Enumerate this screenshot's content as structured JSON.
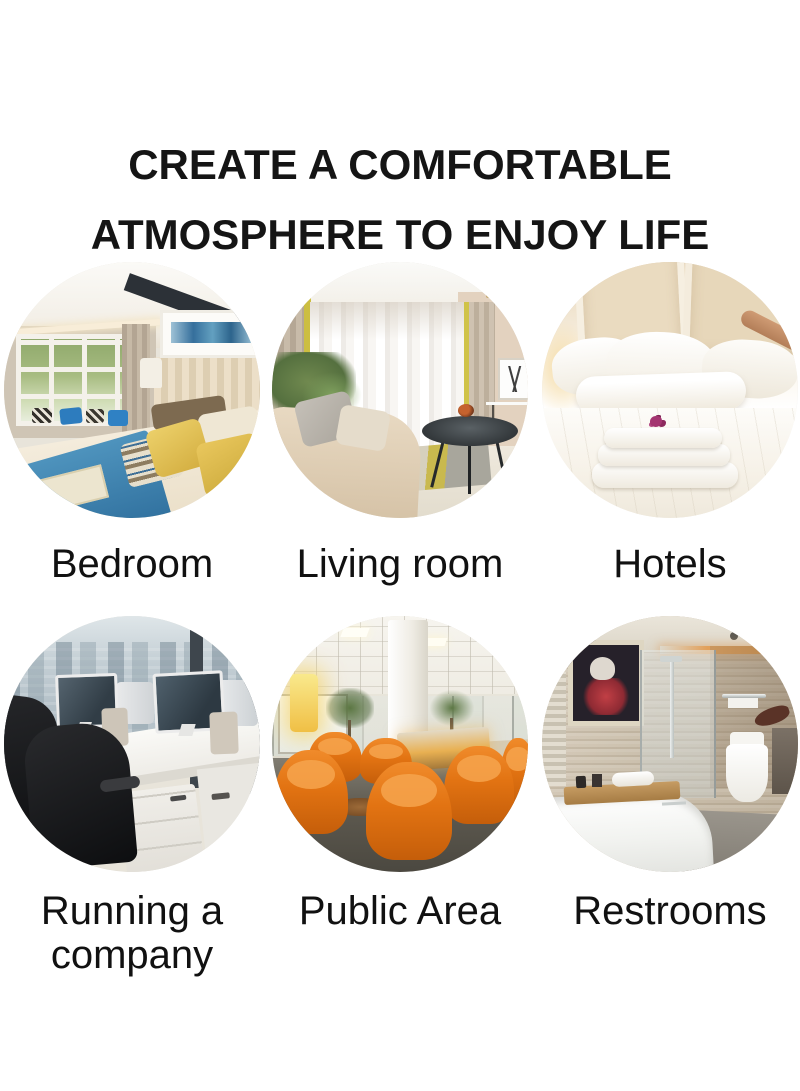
{
  "page": {
    "background_color": "#ffffff"
  },
  "header": {
    "title_line1": "CREATE A COMFORTABLE",
    "title_line2": "ATMOSPHERE TO ENJOY LIFE",
    "text_color": "#151515"
  },
  "gallery": {
    "label_color": "#111111",
    "items": [
      {
        "id": "bedroom",
        "label": "Bedroom"
      },
      {
        "id": "living-room",
        "label": "Living room"
      },
      {
        "id": "hotels",
        "label": "Hotels"
      },
      {
        "id": "running-a-company",
        "label": "Running a company"
      },
      {
        "id": "public-area",
        "label": "Public Area"
      },
      {
        "id": "restrooms",
        "label": "Restrooms"
      }
    ]
  },
  "palette": {
    "background": "#ffffff",
    "bedroom_runner_blue": "#3a7fab",
    "bedroom_pillow_yellow": "#dcba4c",
    "public_area_chair_orange": "#e27312",
    "hotel_flower_magenta": "#a43571",
    "lamp_yellow": "#f0bf45"
  }
}
